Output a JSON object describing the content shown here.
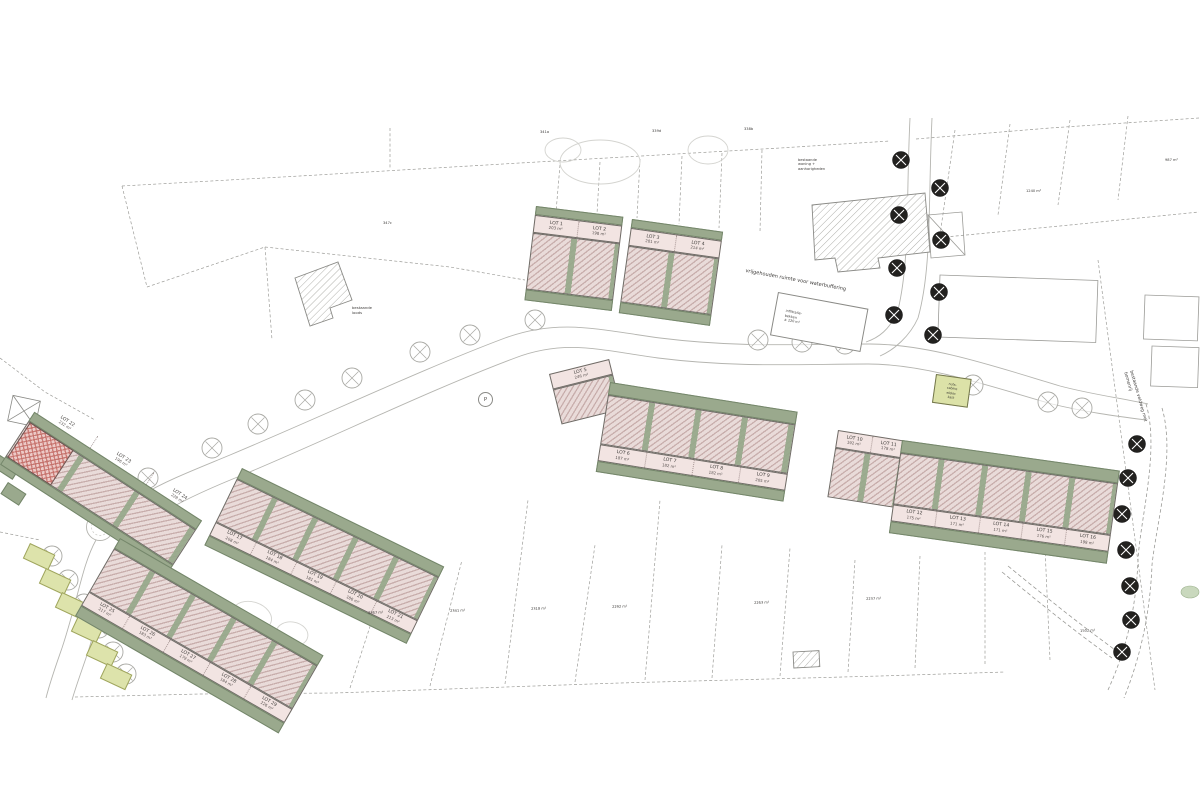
{
  "drawing": {
    "kind": "residential subdivision site plan",
    "colors": {
      "building_hatch": "#d9bdbb",
      "front_band": "#f2e4e2",
      "garden_green": "#9aa98d",
      "planting_yellow": "#dde3ab",
      "red_unit": "#c46a64",
      "line_gray": "#9c9c98",
      "tree_dark": "#22211f"
    }
  },
  "rows": {
    "a1": {
      "lots": [
        {
          "name": "LOT 1",
          "area": "203 m²"
        },
        {
          "name": "LOT 2",
          "area": "198 m²"
        }
      ]
    },
    "a2": {
      "lots": [
        {
          "name": "LOT 3",
          "area": "201 m²"
        },
        {
          "name": "LOT 4",
          "area": "214 m²"
        }
      ]
    },
    "e_left": {
      "lots": [
        {
          "name": "LOT 5",
          "area": "246 m²"
        }
      ]
    },
    "e_main": {
      "lots": [
        {
          "name": "LOT 6",
          "area": "187 m²"
        },
        {
          "name": "LOT 7",
          "area": "182 m²"
        },
        {
          "name": "LOT 8",
          "area": "182 m²"
        },
        {
          "name": "LOT 9",
          "area": "205 m²"
        }
      ]
    },
    "f_left": {
      "lots": [
        {
          "name": "LOT 10",
          "area": "192 m²"
        },
        {
          "name": "LOT 11",
          "area": "178 m²"
        }
      ]
    },
    "f_main": {
      "lots": [
        {
          "name": "LOT 12",
          "area": "175 m²"
        },
        {
          "name": "LOT 13",
          "area": "171 m²"
        },
        {
          "name": "LOT 14",
          "area": "171 m²"
        },
        {
          "name": "LOT 15",
          "area": "176 m²"
        },
        {
          "name": "LOT 16",
          "area": "198 m²"
        }
      ]
    },
    "d": {
      "lots": [
        {
          "name": "LOT 17",
          "area": "208 m²"
        },
        {
          "name": "LOT 18",
          "area": "184 m²"
        },
        {
          "name": "LOT 19",
          "area": "181 m²"
        },
        {
          "name": "LOT 20",
          "area": "186 m²"
        },
        {
          "name": "LOT 21",
          "area": "213 m²"
        }
      ]
    },
    "b": {
      "lots": [
        {
          "name": "LOT 22",
          "area": "232 m²"
        },
        {
          "name": "LOT 23",
          "area": "196 m²"
        },
        {
          "name": "LOT 24",
          "area": "228 m²"
        }
      ]
    },
    "c": {
      "lots": [
        {
          "name": "LOT 25",
          "area": "217 m²"
        },
        {
          "name": "LOT 26",
          "area": "183 m²"
        },
        {
          "name": "LOT 27",
          "area": "179 m²"
        },
        {
          "name": "LOT 28",
          "area": "184 m²"
        },
        {
          "name": "LOT 29",
          "area": "226 m²"
        }
      ]
    }
  },
  "reserved_zone": {
    "label": "vrijgehouden ruimte voor waterbuffering",
    "note": "infiltratie-\nbekken\n± 120 m³"
  },
  "cabin": {
    "lines": [
      "nuts-",
      "cabine",
      "elektr.",
      "kast"
    ]
  },
  "annotations": [
    {
      "text": "347c"
    },
    {
      "text": "341a"
    },
    {
      "text": "339d"
    },
    {
      "text": "338b"
    },
    {
      "text": "bestaande\nloods"
    },
    {
      "text": "bestaande\nwoning +\naanhorigheden"
    },
    {
      "text": "bestaande veldweg met bomenrij"
    },
    {
      "text": "2367 m²"
    },
    {
      "text": "2341 m²"
    },
    {
      "text": "2318 m²"
    },
    {
      "text": "2292 m²"
    },
    {
      "text": "2263 m²"
    },
    {
      "text": "2237 m²"
    },
    {
      "text": "1502 m²"
    },
    {
      "text": "1240 m²"
    },
    {
      "text": "987 m²"
    },
    {
      "text": "P"
    }
  ]
}
